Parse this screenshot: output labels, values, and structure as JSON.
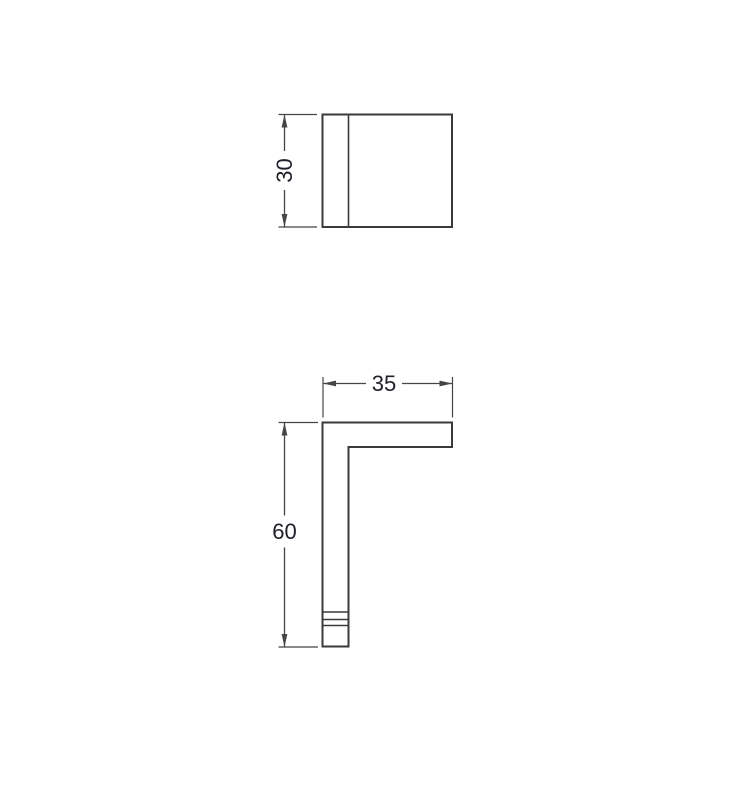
{
  "title": "Dimensioned technical drawing, two orthographic views",
  "colors": {
    "background": "#ffffff",
    "outline": "#3a3a3a",
    "dimension": "#454545",
    "text": "#20202a"
  },
  "top_view": {
    "height_dim_label": "30"
  },
  "side_view": {
    "width_dim_label": "35",
    "height_dim_label": "60"
  }
}
